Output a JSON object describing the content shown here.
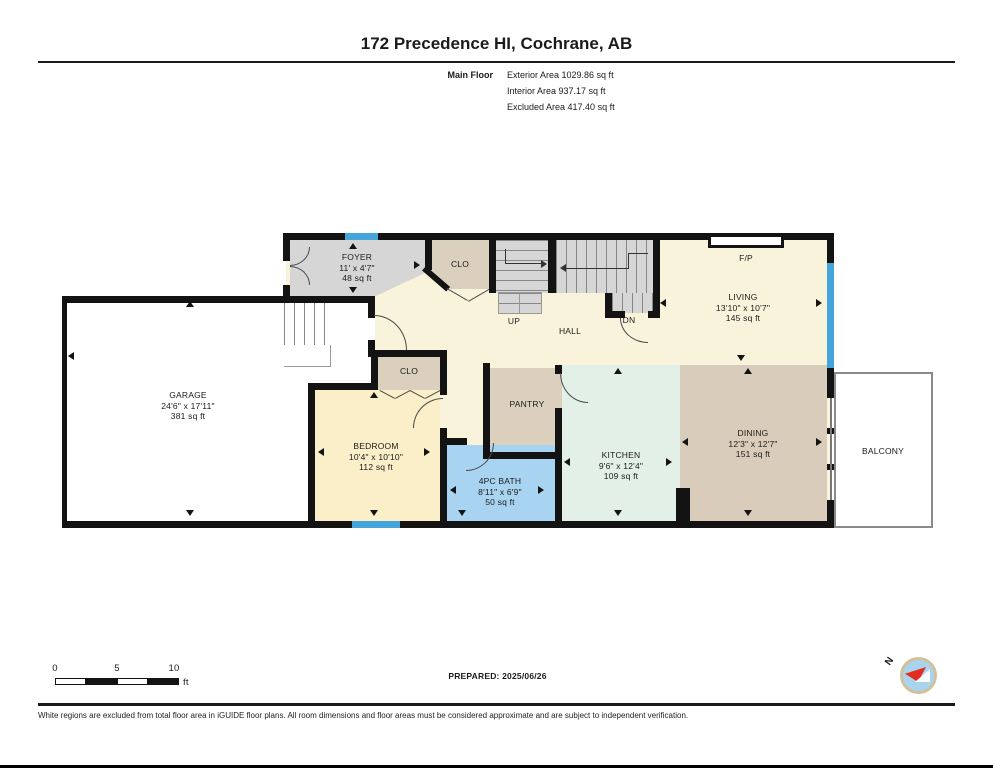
{
  "header": {
    "title": "172 Precedence HI, Cochrane, AB",
    "floor_label": "Main Floor",
    "stats": [
      "Exterior Area 1029.86 sq ft",
      "Interior Area 937.17 sq ft",
      "Excluded Area 417.40 sq ft"
    ]
  },
  "rooms": {
    "foyer": {
      "name": "FOYER",
      "dims": "11' x 4'7\"",
      "area": "48 sq ft"
    },
    "clo_upper": {
      "name": "CLO"
    },
    "up": {
      "name": "UP"
    },
    "dn": {
      "name": "DN"
    },
    "hall": {
      "name": "HALL"
    },
    "fireplace": {
      "name": "F/P"
    },
    "living": {
      "name": "LIVING",
      "dims": "13'10\" x 10'7\"",
      "area": "145 sq ft"
    },
    "garage": {
      "name": "GARAGE",
      "dims": "24'6\" x 17'11\"",
      "area": "381 sq ft"
    },
    "clo_bedroom": {
      "name": "CLO"
    },
    "bedroom": {
      "name": "BEDROOM",
      "dims": "10'4\" x 10'10\"",
      "area": "112 sq ft"
    },
    "bath": {
      "name": "4PC BATH",
      "dims": "8'11\" x 6'9\"",
      "area": "50 sq ft"
    },
    "pantry": {
      "name": "PANTRY"
    },
    "kitchen": {
      "name": "KITCHEN",
      "dims": "9'6\" x 12'4\"",
      "area": "109 sq ft"
    },
    "dining": {
      "name": "DINING",
      "dims": "12'3\" x 12'7\"",
      "area": "151 sq ft"
    },
    "balcony": {
      "name": "BALCONY"
    }
  },
  "scale_bar": {
    "labels": [
      "0",
      "5",
      "10"
    ],
    "unit": "ft"
  },
  "footer": {
    "prepared": "PREPARED: 2025/06/26",
    "compass_label": "N",
    "disclaimer": "White regions are excluded from total floor area in iGUIDE floor plans. All room dimensions and floor areas must be considered approximate and are subject to independent verification."
  },
  "colors": {
    "wall": "#131313",
    "floor_cream": "#FAF3DC",
    "floor_gray": "#D6D6D6",
    "floor_tan": "#DBCFBD",
    "floor_yellow": "#FAEFC9",
    "floor_blue": "#A9D4F1",
    "floor_mint": "#E3F0E8",
    "window_blue": "#45A5DA"
  }
}
